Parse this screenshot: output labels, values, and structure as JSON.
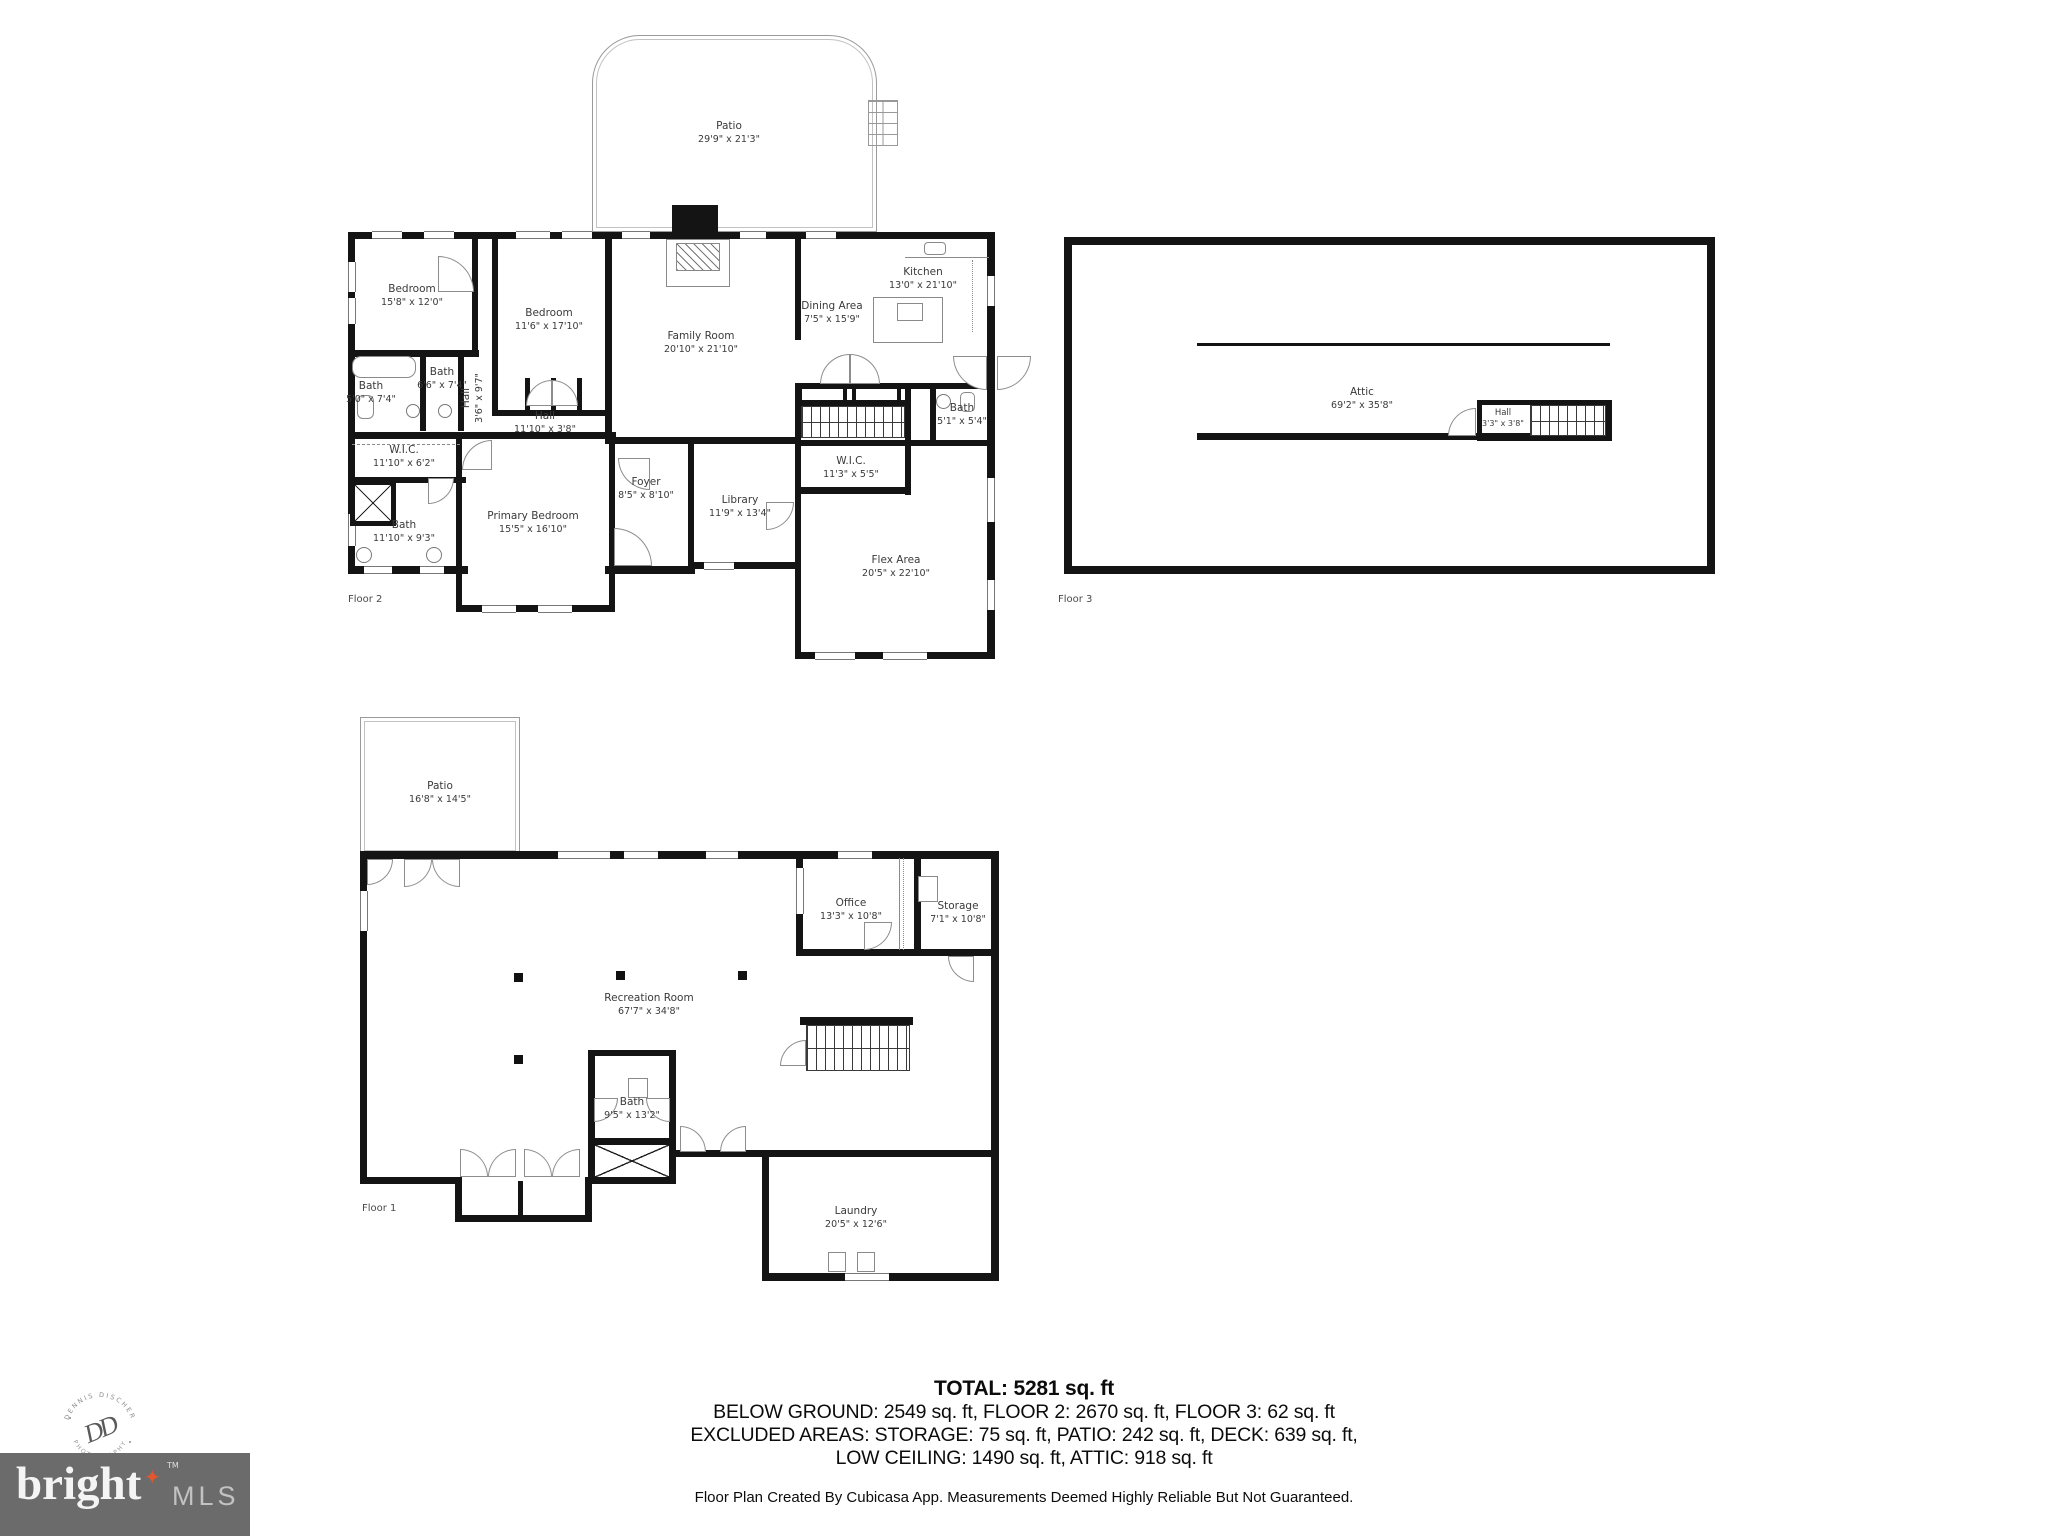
{
  "floor2": {
    "tag": "Floor 2",
    "rooms": [
      {
        "name": "Patio",
        "dims": "29'9\" x 21'3\""
      },
      {
        "name": "Bedroom",
        "dims": "15'8\" x 12'0\""
      },
      {
        "name": "Bedroom",
        "dims": "11'6\" x 17'10\""
      },
      {
        "name": "Family Room",
        "dims": "20'10\" x 21'10\""
      },
      {
        "name": "Kitchen",
        "dims": "13'0\" x 21'10\""
      },
      {
        "name": "Dining Area",
        "dims": "7'5\" x 15'9\""
      },
      {
        "name": "Bath",
        "dims": "5'0\" x 7'4\""
      },
      {
        "name": "Bath",
        "dims": "6'6\" x 7'4\""
      },
      {
        "name": "Hall",
        "dims": "3'6\" x 9'7\""
      },
      {
        "name": "Hall",
        "dims": "11'10\" x 3'8\""
      },
      {
        "name": "W.I.C.",
        "dims": "11'10\" x 6'2\""
      },
      {
        "name": "Bath",
        "dims": "11'10\" x 9'3\""
      },
      {
        "name": "Primary Bedroom",
        "dims": "15'5\" x 16'10\""
      },
      {
        "name": "Foyer",
        "dims": "8'5\" x 8'10\""
      },
      {
        "name": "Library",
        "dims": "11'9\" x 13'4\""
      },
      {
        "name": "W.I.C.",
        "dims": "11'3\" x 5'5\""
      },
      {
        "name": "Bath",
        "dims": "5'1\" x 5'4\""
      },
      {
        "name": "Flex Area",
        "dims": "20'5\" x 22'10\""
      }
    ]
  },
  "floor3": {
    "tag": "Floor 3",
    "rooms": [
      {
        "name": "Attic",
        "dims": "69'2\" x 35'8\""
      },
      {
        "name": "Hall",
        "dims": "3'3\" x 3'8\""
      }
    ]
  },
  "floor1": {
    "tag": "Floor 1",
    "rooms": [
      {
        "name": "Patio",
        "dims": "16'8\" x 14'5\""
      },
      {
        "name": "Recreation Room",
        "dims": "67'7\" x 34'8\""
      },
      {
        "name": "Office",
        "dims": "13'3\" x 10'8\""
      },
      {
        "name": "Storage",
        "dims": "7'1\" x 10'8\""
      },
      {
        "name": "Bath",
        "dims": "9'5\" x 13'2\""
      },
      {
        "name": "Laundry",
        "dims": "20'5\" x 12'6\""
      }
    ]
  },
  "summary": {
    "total": "TOTAL: 5281 sq. ft",
    "line2": "BELOW GROUND: 2549 sq. ft, FLOOR 2: 2670 sq. ft, FLOOR 3: 62 sq. ft",
    "line3": "EXCLUDED AREAS: STORAGE: 75 sq. ft, PATIO: 242 sq. ft, DECK: 639 sq. ft,",
    "line4": "LOW CEILING: 1490 sq. ft, ATTIC: 918 sq. ft"
  },
  "footer": "Floor Plan Created By Cubicasa App. Measurements Deemed Highly Reliable But Not Guaranteed.",
  "logo": {
    "brand": "bright",
    "tm": "TM",
    "suffix": "MLS",
    "star_glyph": "✦",
    "star_color": "#e4572e",
    "bg_color": "#6b6b6b"
  },
  "watermark": {
    "arc_top": "DENNIS DISCHER",
    "arc_bottom": "PHOTOGRAPHY",
    "monogram": "DD"
  }
}
